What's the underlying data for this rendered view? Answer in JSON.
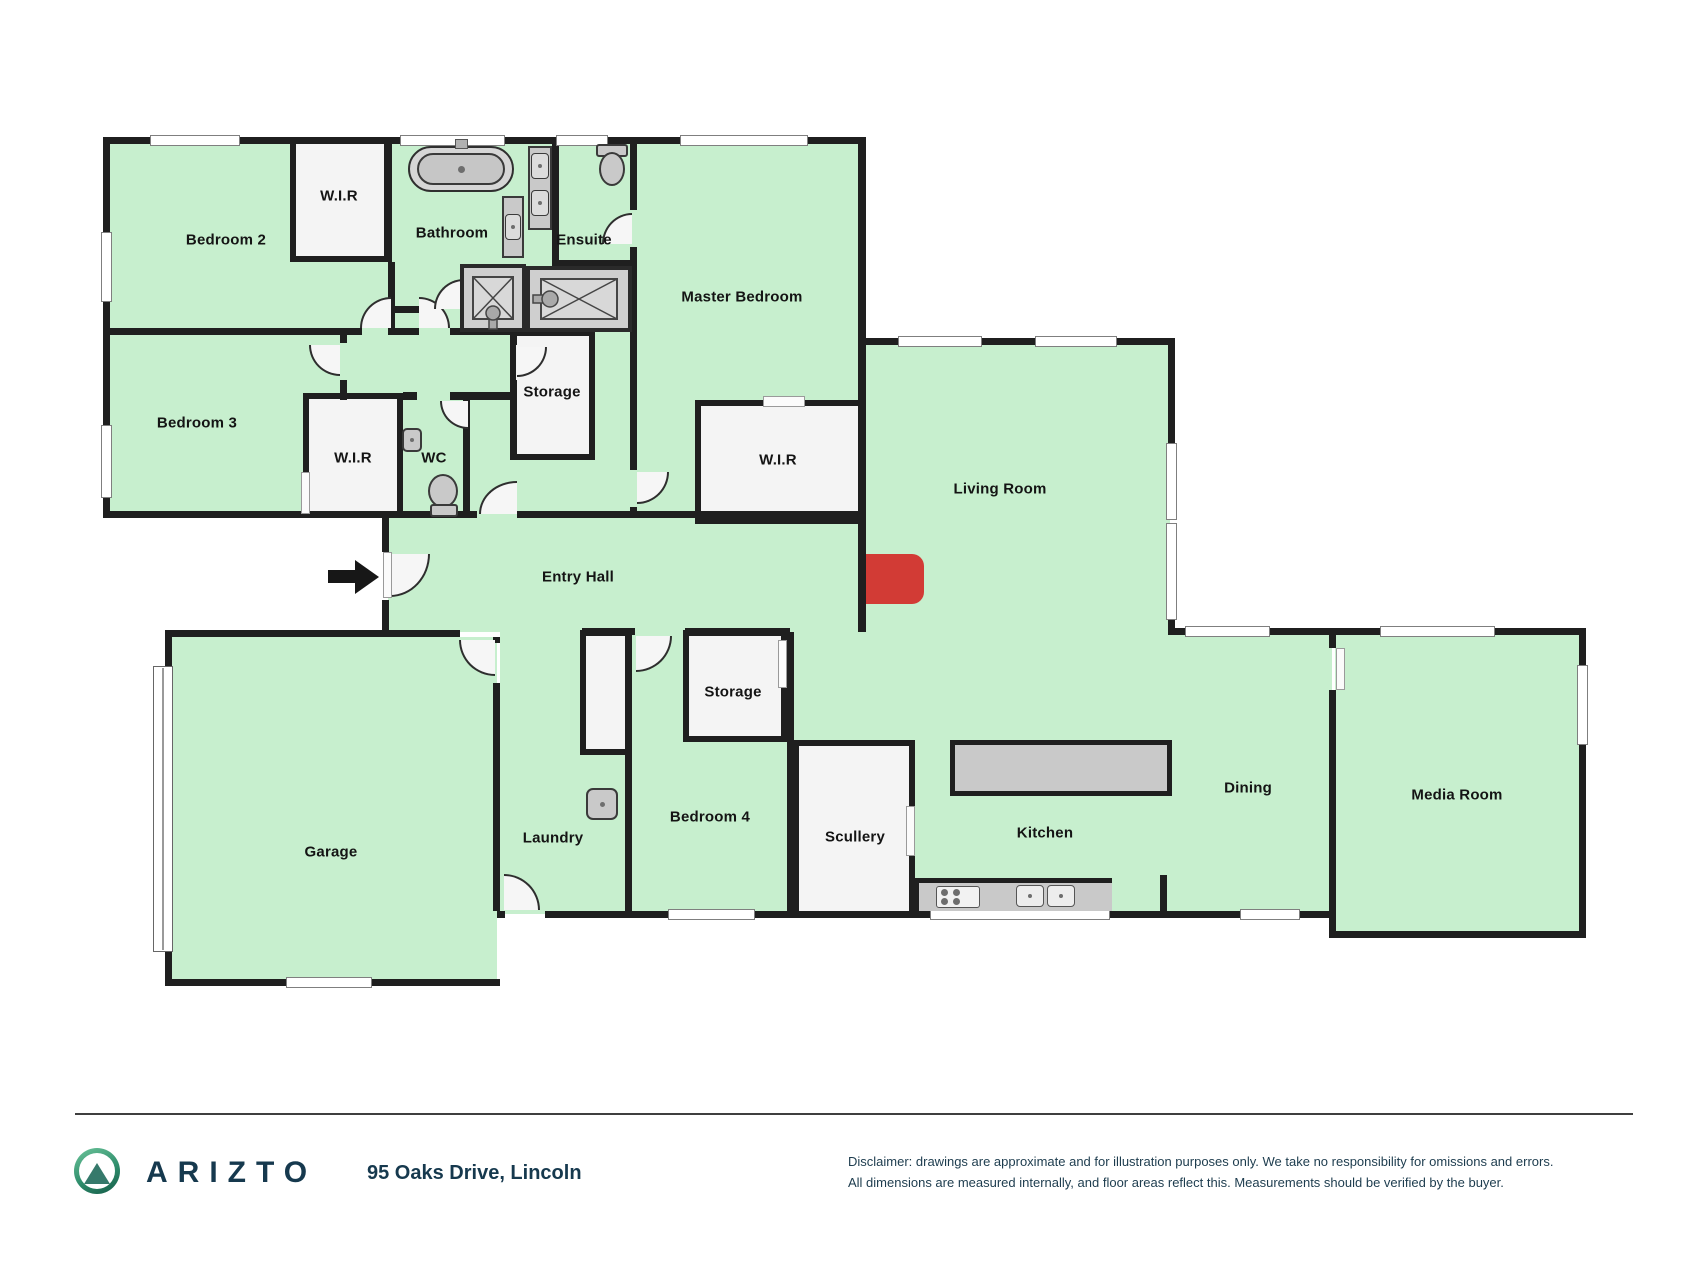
{
  "floorplan": {
    "rooms": [
      {
        "name": "bedroom-2",
        "label": "Bedroom 2",
        "x": 226,
        "y": 240
      },
      {
        "name": "wir-bedroom-2",
        "label": "W.I.R",
        "x": 339,
        "y": 196
      },
      {
        "name": "bathroom",
        "label": "Bathroom",
        "x": 452,
        "y": 233
      },
      {
        "name": "ensuite",
        "label": "Ensuite",
        "x": 584,
        "y": 240
      },
      {
        "name": "master-bedroom",
        "label": "Master Bedroom",
        "x": 742,
        "y": 297
      },
      {
        "name": "bedroom-3",
        "label": "Bedroom 3",
        "x": 197,
        "y": 423
      },
      {
        "name": "wir-bedroom-3",
        "label": "W.I.R",
        "x": 353,
        "y": 458
      },
      {
        "name": "wc",
        "label": "WC",
        "x": 434,
        "y": 458
      },
      {
        "name": "storage-upper",
        "label": "Storage",
        "x": 552,
        "y": 392
      },
      {
        "name": "wir-master",
        "label": "W.I.R",
        "x": 778,
        "y": 460
      },
      {
        "name": "living-room",
        "label": "Living Room",
        "x": 1000,
        "y": 489
      },
      {
        "name": "entry-hall",
        "label": "Entry Hall",
        "x": 578,
        "y": 577
      },
      {
        "name": "garage",
        "label": "Garage",
        "x": 331,
        "y": 852
      },
      {
        "name": "laundry",
        "label": "Laundry",
        "x": 553,
        "y": 838
      },
      {
        "name": "storage-lower",
        "label": "Storage",
        "x": 733,
        "y": 692
      },
      {
        "name": "bedroom-4",
        "label": "Bedroom 4",
        "x": 710,
        "y": 817
      },
      {
        "name": "scullery",
        "label": "Scullery",
        "x": 855,
        "y": 837
      },
      {
        "name": "kitchen",
        "label": "Kitchen",
        "x": 1045,
        "y": 833
      },
      {
        "name": "dining",
        "label": "Dining",
        "x": 1248,
        "y": 788
      },
      {
        "name": "media-room",
        "label": "Media Room",
        "x": 1457,
        "y": 795
      }
    ],
    "colors": {
      "room_fill": "#c7efce",
      "wall": "#1f1f1f",
      "closet_fill": "#f4f4f4",
      "fixture_gray": "#c9c9c9",
      "fireplace_red": "#d23b35"
    }
  },
  "footer": {
    "brand": "ARIZTO",
    "address": "95 Oaks Drive, Lincoln",
    "disclaimer_line1": "Disclaimer: drawings are approximate and for illustration purposes only. We take no responsibility for omissions and errors.",
    "disclaimer_line2": "All dimensions are measured internally, and floor areas reflect this. Measurements should be verified by the buyer."
  }
}
